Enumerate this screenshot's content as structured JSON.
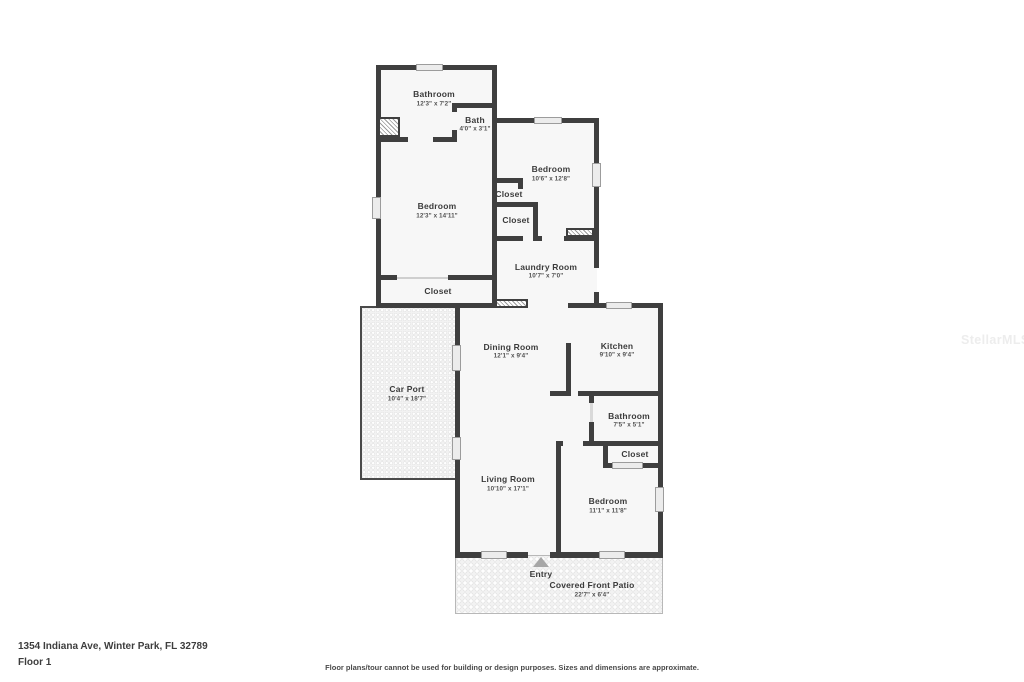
{
  "colors": {
    "wall": "#3f3f3f",
    "room_fill": "#f7f7f7",
    "window_fill": "#ececec",
    "texture_fill": "#f2f2f2",
    "entry_arrow": "#a6a6a6"
  },
  "rooms": {
    "bathroom_upper": {
      "label": "Bathroom",
      "dims": "12'3\" x 7'2\""
    },
    "bath": {
      "label": "Bath",
      "dims": "4'0\" x 3'1\""
    },
    "bedroom_upper_left": {
      "label": "Bedroom",
      "dims": "12'3\" x 14'11\""
    },
    "closet_upper_left": {
      "label": "Closet"
    },
    "bedroom_upper_right": {
      "label": "Bedroom",
      "dims": "10'6\" x 12'8\""
    },
    "closet_small_1": {
      "label": "Closet"
    },
    "closet_small_2": {
      "label": "Closet"
    },
    "laundry": {
      "label": "Laundry Room",
      "dims": "10'7\" x 7'0\""
    },
    "dining": {
      "label": "Dining Room",
      "dims": "12'1\" x 9'4\""
    },
    "kitchen": {
      "label": "Kitchen",
      "dims": "9'10\" x 9'4\""
    },
    "bathroom_main": {
      "label": "Bathroom",
      "dims": "7'5\" x 5'1\""
    },
    "closet_main": {
      "label": "Closet"
    },
    "living": {
      "label": "Living Room",
      "dims": "10'10\" x 17'1\""
    },
    "bedroom_main": {
      "label": "Bedroom",
      "dims": "11'1\" x 11'8\""
    },
    "carport": {
      "label": "Car Port",
      "dims": "10'4\" x 18'7\""
    },
    "patio": {
      "label": "Covered Front Patio",
      "dims": "22'7\" x 6'4\""
    },
    "entry": {
      "label": "Entry"
    }
  },
  "footer": {
    "address": "1354 Indiana Ave, Winter Park, FL 32789",
    "floor": "Floor 1",
    "disclaimer": "Floor plans/tour cannot be used for building or design purposes. Sizes and dimensions are approximate."
  },
  "watermark": "StellarMLS"
}
